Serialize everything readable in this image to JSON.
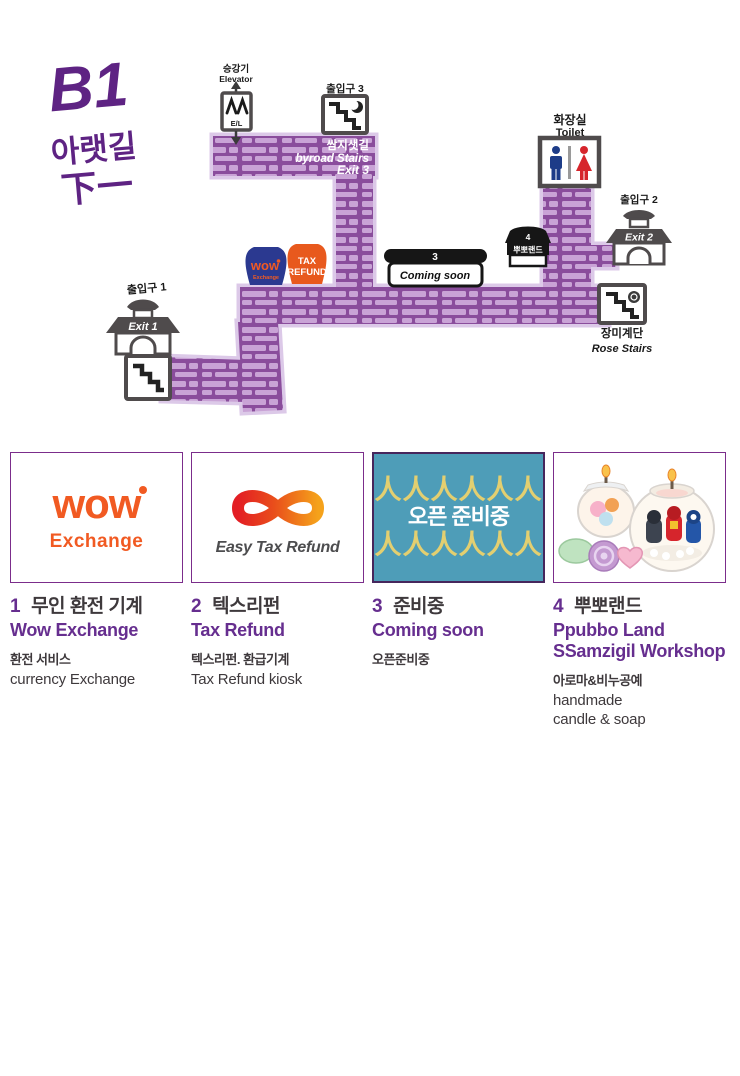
{
  "title": {
    "floor": "B1",
    "korean": "아랫길",
    "hanja": "下一"
  },
  "map": {
    "elevator": {
      "label_ko": "승강기",
      "label_en": "Elevator",
      "icon_text": "E/L"
    },
    "exit3": {
      "label": "출입구 3"
    },
    "byroad": {
      "line1": "쌈지샛길",
      "line2": "byroad Stairs",
      "line3": "Exit 3"
    },
    "toilet": {
      "label_ko": "화장실",
      "label_en": "Toilet"
    },
    "exit2": {
      "label": "출입구 2",
      "gate_text": "Exit 2"
    },
    "exit1": {
      "label": "출입구 1",
      "gate_text": "Exit 1"
    },
    "rose_stairs": {
      "label_ko": "장미계단",
      "label_en": "Rose Stairs"
    },
    "shops": {
      "wow": {
        "name": "wow",
        "sub": "Exchange"
      },
      "tax": {
        "line1": "TAX",
        "line2": "REFUND"
      },
      "coming": {
        "number": "3",
        "text": "Coming soon"
      },
      "ppubbo": {
        "number": "4",
        "text": "뿌뽀랜드"
      }
    }
  },
  "legend": {
    "items": [
      {
        "number": "1",
        "title_ko": "무인 환전 기계",
        "title_en": "Wow Exchange",
        "desc_ko": "환전 서비스",
        "desc_en": "currency Exchange",
        "logo_main": "wow",
        "logo_sub": "Exchange"
      },
      {
        "number": "2",
        "title_ko": "텍스리펀",
        "title_en": "Tax Refund",
        "desc_ko": "텍스리펀. 환급기계",
        "desc_en": "Tax Refund kiosk",
        "logo_text": "Easy Tax Refund"
      },
      {
        "number": "3",
        "title_ko": "준비중",
        "title_en": "Coming soon",
        "desc_ko": "오픈준비중",
        "banner_text": "오픈 준비중",
        "banner_figures": "人人人人人人"
      },
      {
        "number": "4",
        "title_ko": "뿌뽀랜드",
        "title_en": "Ppubbo Land",
        "title_en2": "SSamzigil Workshop",
        "desc_ko": "아로마&비누공예",
        "desc_en": "handmade",
        "desc_en2": "candle & soap"
      }
    ]
  },
  "theme": {
    "title_purple": "#5e2383",
    "corridor_purple": "#8a4d9c",
    "brick_light": "#c9a3d6",
    "corridor_halo": "#dcc9e8",
    "accent_purple": "#662e8f",
    "text_dark": "#3e393c",
    "icon_gray": "#4f4b4c",
    "wow_blue": "#2b3990",
    "wow_orange": "#f15a22",
    "tax_orange": "#e8591d",
    "banner_teal": "#4e9db8",
    "banner_yellow": "#e3cf70",
    "toilet_man_blue": "#1d3c88",
    "toilet_woman_red": "#d6252c"
  }
}
